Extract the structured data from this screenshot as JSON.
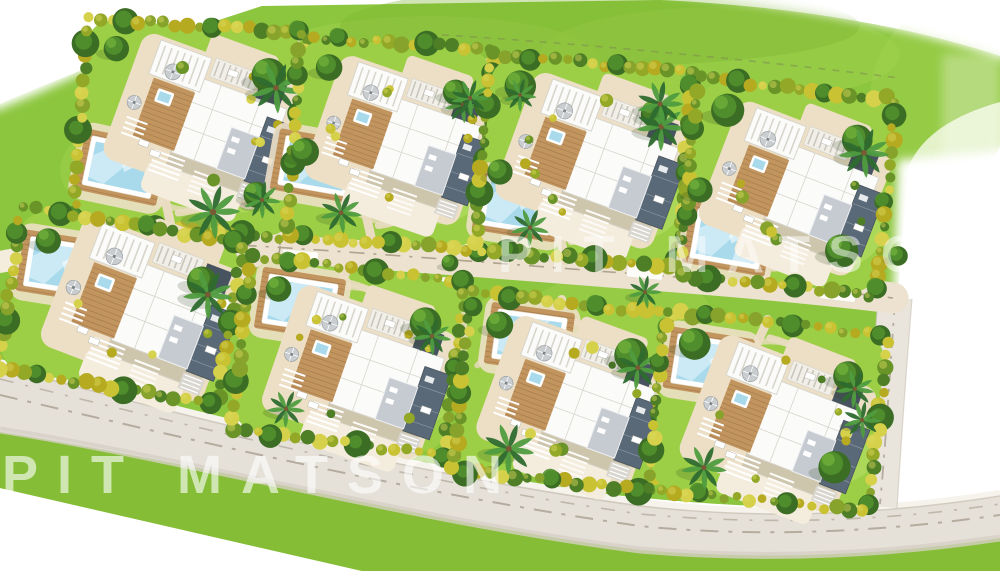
{
  "meta": {
    "description": "Aerial 3D-rendered masterplan site plan of a residential community with eight detached villas, private swimming pools, landscaped gardens, an internal access road with cul-de-sac, and perimeter roads",
    "villa_count": 8
  },
  "watermarks": [
    {
      "id": "watermark-left",
      "text": "PIT MATSON",
      "x": 2,
      "y": 448,
      "font_size": 54,
      "letter_spacing": 19,
      "opacity": 0.62
    },
    {
      "id": "watermark-right",
      "text": "PIT MATSON",
      "x": 498,
      "y": 229,
      "font_size": 52,
      "letter_spacing": 18,
      "opacity": 0.5
    }
  ],
  "palette": {
    "white": "#ffffff",
    "grass": "#8cc63e",
    "grass_dark": "#7cb32e",
    "grass_light": "#a8d655",
    "lawn": "#9ccf46",
    "lawn_light": "#c0e271",
    "hedge_colors": [
      "#b5aa20",
      "#c9c232",
      "#94a827",
      "#6a9428",
      "#4e7e26",
      "#d6d14b",
      "#87a32c"
    ],
    "tree_dark": "#3c6d25",
    "tree_mid": "#51902e",
    "tree_light": "#6cab39",
    "palm_dark": "#2e6b2f",
    "palm_light": "#4f9c3f",
    "trunk": "#7a5a35",
    "sand": "#ecdfc5",
    "sand_light": "#f4ecdc",
    "path": "#eadcc0",
    "road_access": "#ece2cf",
    "road_access_dash": "#a89c86",
    "road_main": "#e5e1d9",
    "road_main_dark": "#d6d0c5",
    "road_dash": "#b4ac9e",
    "curb_light": "#f6f3ec",
    "curb_dark": "#c8c1b2",
    "road_east": "#e9e5dd",
    "pool_water": "#a9daec",
    "pool_light": "#d3eef8",
    "pool_rim": "#ffffff",
    "roof_white": "#fbfbf9",
    "roof_seam": "#d7d5cc",
    "roof_gray": "#c6cbd1",
    "roof_dark": "#5a6977",
    "roof_dark2": "#47545f",
    "wood": "#c2955f",
    "wood_dark": "#a0774a",
    "shadow": "rgba(40,60,20,0.18)",
    "boundary_dash": "#7d8c52"
  },
  "site": {
    "cul_de_sac": {
      "cx": 258,
      "cy": 246,
      "r": 36,
      "ring_r": 22
    },
    "roads": {
      "access_road": {
        "label": "internal access road",
        "marking": "dash-dot centerline"
      },
      "main_road": {
        "label": "perimeter road",
        "marking": "two dash-dot lane lines"
      },
      "east_road": {
        "label": "east connector road",
        "marking": "dash-dot centerline"
      }
    },
    "driveway_pads": [
      {
        "x": 452,
        "y": 237,
        "rot": 6
      },
      {
        "x": 455,
        "y": 286,
        "rot": 6
      },
      {
        "x": 645,
        "y": 271,
        "rot": 6
      },
      {
        "x": 838,
        "y": 293,
        "rot": 7
      },
      {
        "x": 300,
        "y": 258,
        "rot": 5
      }
    ],
    "villas": [
      {
        "id": "villa-1",
        "cx": 190,
        "cy": 128,
        "w": 218,
        "h": 204,
        "rot": 4,
        "house": {
          "dx": 12,
          "dy": -10,
          "rot": 20,
          "s": 1.0
        },
        "pool": {
          "dx": -66,
          "dy": 44,
          "rot": 12
        },
        "trees": 3,
        "palms": 1
      },
      {
        "id": "villa-2",
        "cx": 390,
        "cy": 143,
        "w": 192,
        "h": 198,
        "rot": 4,
        "house": {
          "dx": 10,
          "dy": -6,
          "rot": 19,
          "s": 0.97
        },
        "pool": {
          "dx": -72,
          "dy": 28,
          "rot": 10
        },
        "trees": 2,
        "palms": 2
      },
      {
        "id": "villa-3",
        "cx": 584,
        "cy": 161,
        "w": 200,
        "h": 194,
        "rot": 5,
        "house": {
          "dx": 10,
          "dy": -4,
          "rot": 20,
          "s": 1.0
        },
        "pool": {
          "dx": -62,
          "dy": 50,
          "rot": 9
        },
        "trees": 2,
        "palms": 2
      },
      {
        "id": "villa-4",
        "cx": 788,
        "cy": 187,
        "w": 196,
        "h": 196,
        "rot": 6,
        "house": {
          "dx": 8,
          "dy": -2,
          "rot": 21,
          "s": 0.98
        },
        "pool": {
          "dx": -54,
          "dy": 58,
          "rot": 10
        },
        "trees": 3,
        "palms": 1
      },
      {
        "id": "villa-5",
        "cx": 120,
        "cy": 306,
        "w": 222,
        "h": 162,
        "rot": 9,
        "house": {
          "dx": 24,
          "dy": -4,
          "rot": 21,
          "s": 1.04
        },
        "pool": {
          "dx": -64,
          "dy": -30,
          "rot": 9
        },
        "trees": 2,
        "palms": 1
      },
      {
        "id": "villa-6",
        "cx": 348,
        "cy": 356,
        "w": 214,
        "h": 172,
        "rot": 7,
        "house": {
          "dx": 14,
          "dy": 12,
          "rot": 19,
          "s": 1.0
        },
        "pool": {
          "dx": -54,
          "dy": -46,
          "rot": 9
        },
        "trees": 2,
        "palms": 2
      },
      {
        "id": "villa-7",
        "cx": 562,
        "cy": 392,
        "w": 198,
        "h": 176,
        "rot": 6,
        "house": {
          "dx": 12,
          "dy": 6,
          "rot": 20,
          "s": 0.98
        },
        "pool": {
          "dx": -38,
          "dy": -50,
          "rot": 8
        },
        "trees": 2,
        "palms": 2
      },
      {
        "id": "villa-8",
        "cx": 768,
        "cy": 412,
        "w": 220,
        "h": 176,
        "rot": 6,
        "house": {
          "dx": 12,
          "dy": 8,
          "rot": 21,
          "s": 1.0
        },
        "pool": {
          "dx": -64,
          "dy": -42,
          "rot": 9
        },
        "trees": 3,
        "palms": 2
      }
    ],
    "outside_trees": [
      {
        "x": 213,
        "y": 212,
        "type": "palm",
        "s": 1.3
      },
      {
        "x": 262,
        "y": 200,
        "type": "palm",
        "s": 0.9
      },
      {
        "x": 305,
        "y": 152,
        "type": "tree",
        "s": 1.0
      },
      {
        "x": 470,
        "y": 98,
        "type": "palm",
        "s": 0.9
      },
      {
        "x": 500,
        "y": 172,
        "type": "tree",
        "s": 0.9
      },
      {
        "x": 660,
        "y": 104,
        "type": "palm",
        "s": 1.1
      },
      {
        "x": 700,
        "y": 190,
        "type": "tree",
        "s": 0.9
      },
      {
        "x": 520,
        "y": 95,
        "type": "palm",
        "s": 0.8
      },
      {
        "x": 645,
        "y": 292,
        "type": "palm",
        "s": 0.8
      },
      {
        "x": 862,
        "y": 420,
        "type": "palm",
        "s": 0.9
      },
      {
        "x": 450,
        "y": 263,
        "type": "tree",
        "s": 0.6
      },
      {
        "x": 898,
        "y": 256,
        "type": "tree",
        "s": 0.7
      }
    ]
  }
}
